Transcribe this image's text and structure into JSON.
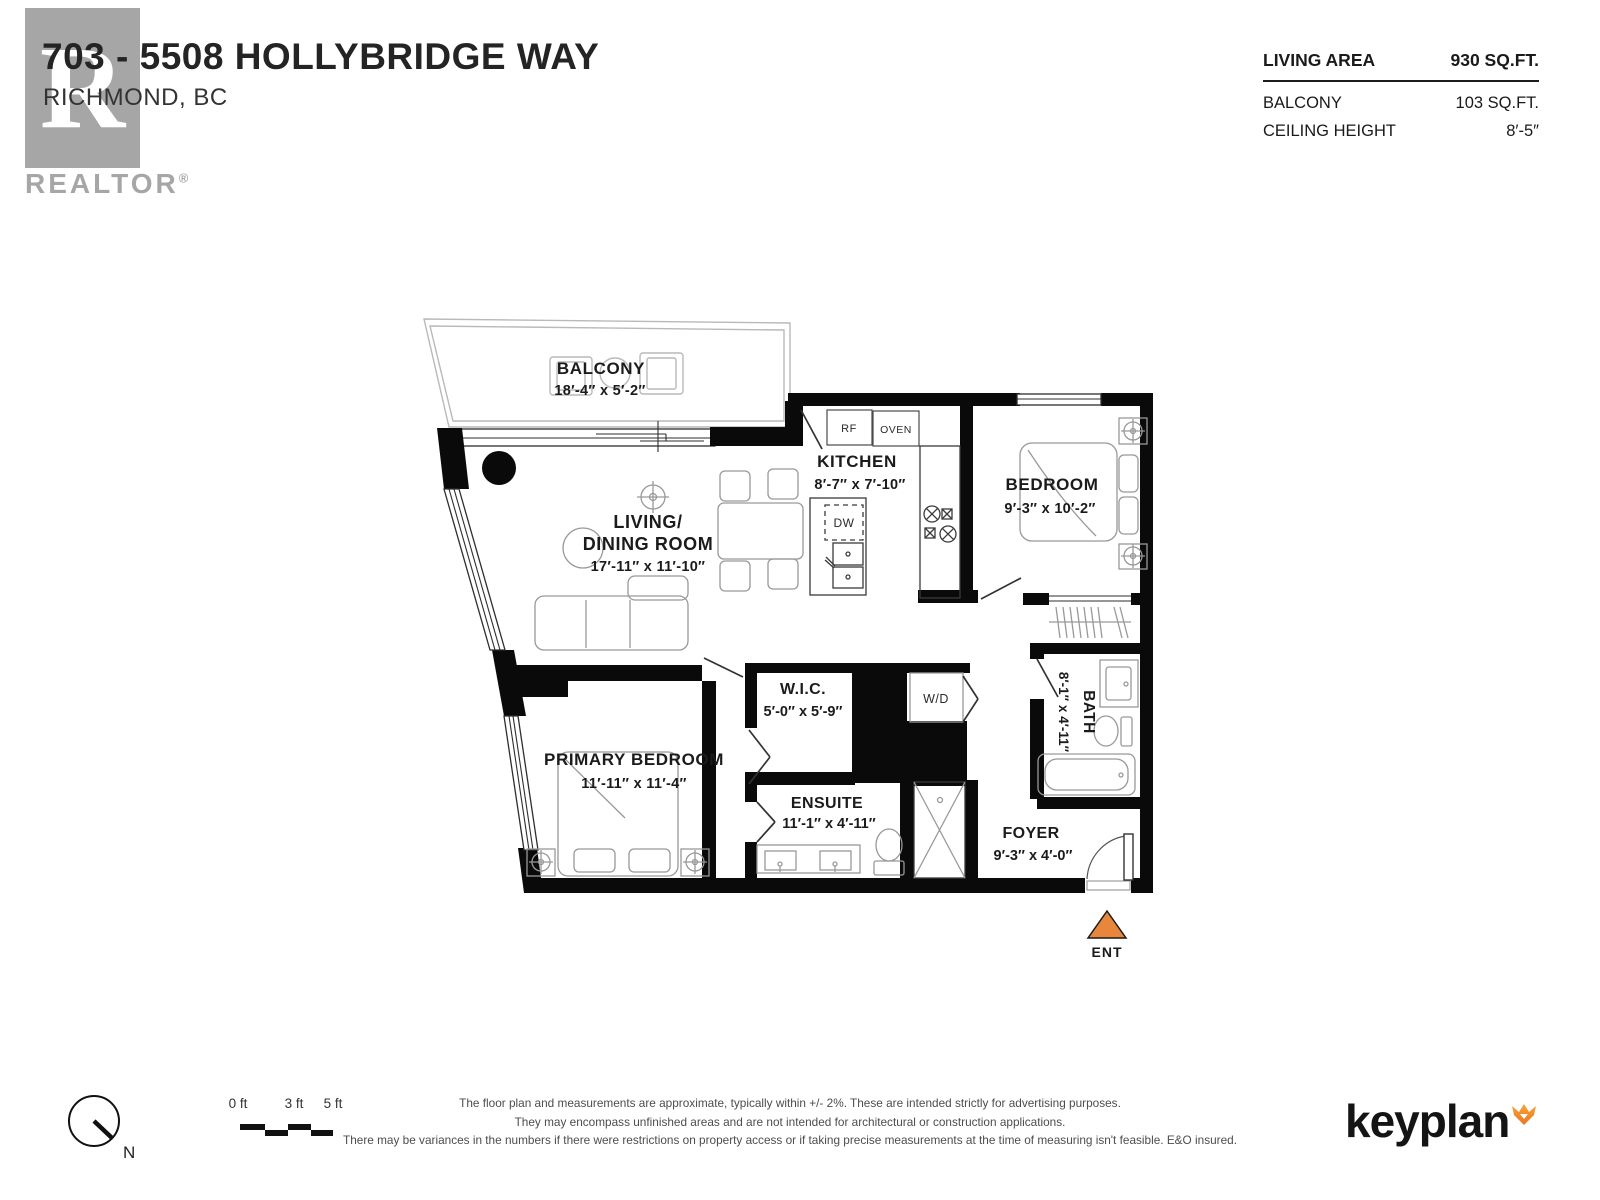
{
  "header": {
    "title": "703 - 5508 HOLLYBRIDGE WAY",
    "subtitle": "RICHMOND, BC",
    "realtor": {
      "logo_letter": "R",
      "wordmark": "REALTOR",
      "registered": "®"
    },
    "stats": [
      {
        "label": "LIVING AREA",
        "value": "930 SQ.FT."
      },
      {
        "label": "BALCONY",
        "value": "103 SQ.FT."
      },
      {
        "label": "CEILING HEIGHT",
        "value": "8′-5″"
      }
    ]
  },
  "plan": {
    "rooms": {
      "balcony": {
        "name": "BALCONY",
        "dims": "18′-4″  x  5′-2″"
      },
      "living": {
        "name_line1": "LIVING/",
        "name_line2": "DINING ROOM",
        "dims": "17′-11″  x  11′-10″"
      },
      "kitchen": {
        "name": "KITCHEN",
        "dims": "8′-7″  x  7′-10″"
      },
      "bedroom": {
        "name": "BEDROOM",
        "dims": "9′-3″  x  10′-2″"
      },
      "wic": {
        "name": "W.I.C.",
        "dims": "5′-0″ x 5′-9″"
      },
      "primary": {
        "name": "PRIMARY BEDROOM",
        "dims": "11′-11″  x  11′-4″"
      },
      "ensuite": {
        "name": "ENSUITE",
        "dims": "11′-1″  x  4′-11″"
      },
      "bath": {
        "name": "BATH",
        "dims": "8′-1″ x 4′-11″"
      },
      "foyer": {
        "name": "FOYER",
        "dims": "9′-3″  x  4′-0″"
      }
    },
    "appliances": {
      "fridge": "RF",
      "oven": "OVEN",
      "dishwasher": "DW",
      "washer_dryer": "W/D"
    },
    "entrance": {
      "label": "ENT",
      "color": "#e8873b"
    }
  },
  "footer": {
    "compass_label": "N",
    "scale": [
      "0 ft",
      "3 ft",
      "5 ft"
    ],
    "disclaimer": [
      "The floor plan and measurements are approximate, typically within +/- 2%. These are intended strictly for advertising purposes.",
      "They may encompass unfinished areas and are not intended for architectural or construction applications.",
      "There may be variances in the numbers if there were restrictions on property access or if taking precise measurements at the time of measuring isn't feasible. E&O insured."
    ],
    "brand": "keyplan"
  }
}
